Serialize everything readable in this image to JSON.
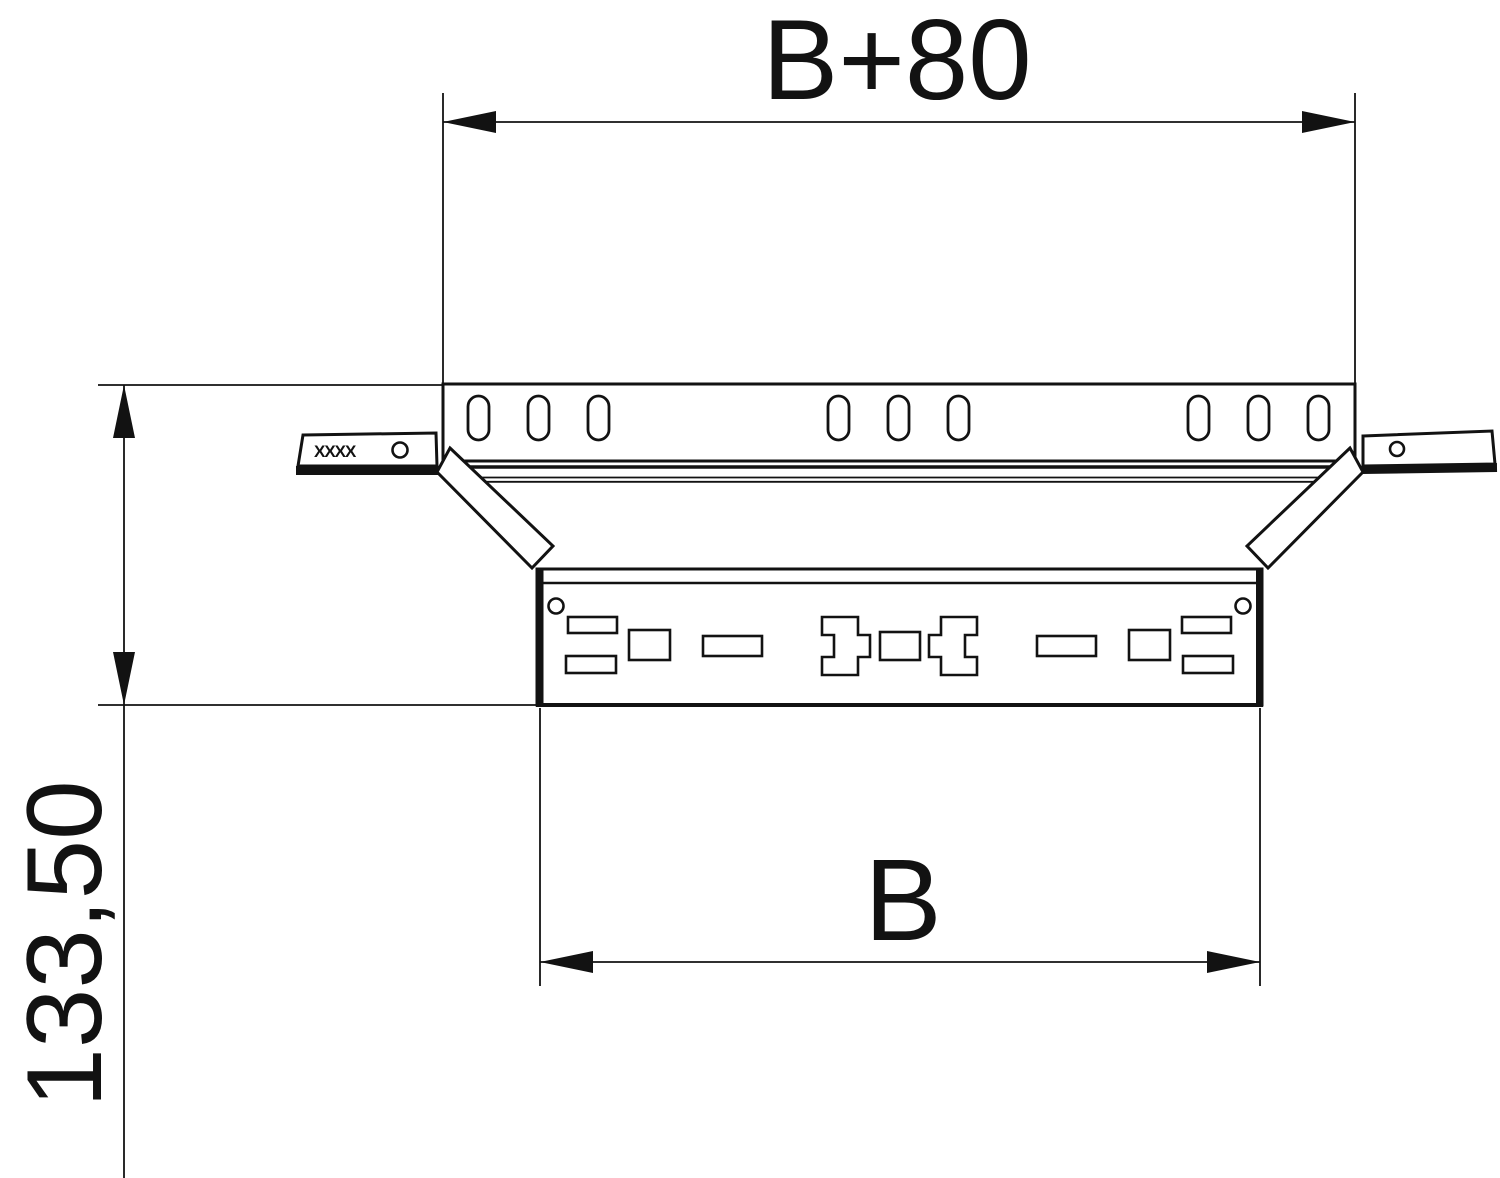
{
  "drawing": {
    "type": "technical-dimension-drawing",
    "part": "cable-tray add-on tee, top view",
    "dimensions": [
      {
        "name": "overall-width",
        "value": "B+80",
        "orientation": "horizontal",
        "position": "top"
      },
      {
        "name": "branch-width",
        "value": "B",
        "orientation": "horizontal",
        "position": "bottom"
      },
      {
        "name": "overall-height",
        "value": "133,50",
        "orientation": "vertical",
        "position": "left"
      }
    ],
    "stamp": {
      "text": "XXXX"
    },
    "colors": {
      "line": "#121212",
      "background": "#ffffff"
    }
  }
}
